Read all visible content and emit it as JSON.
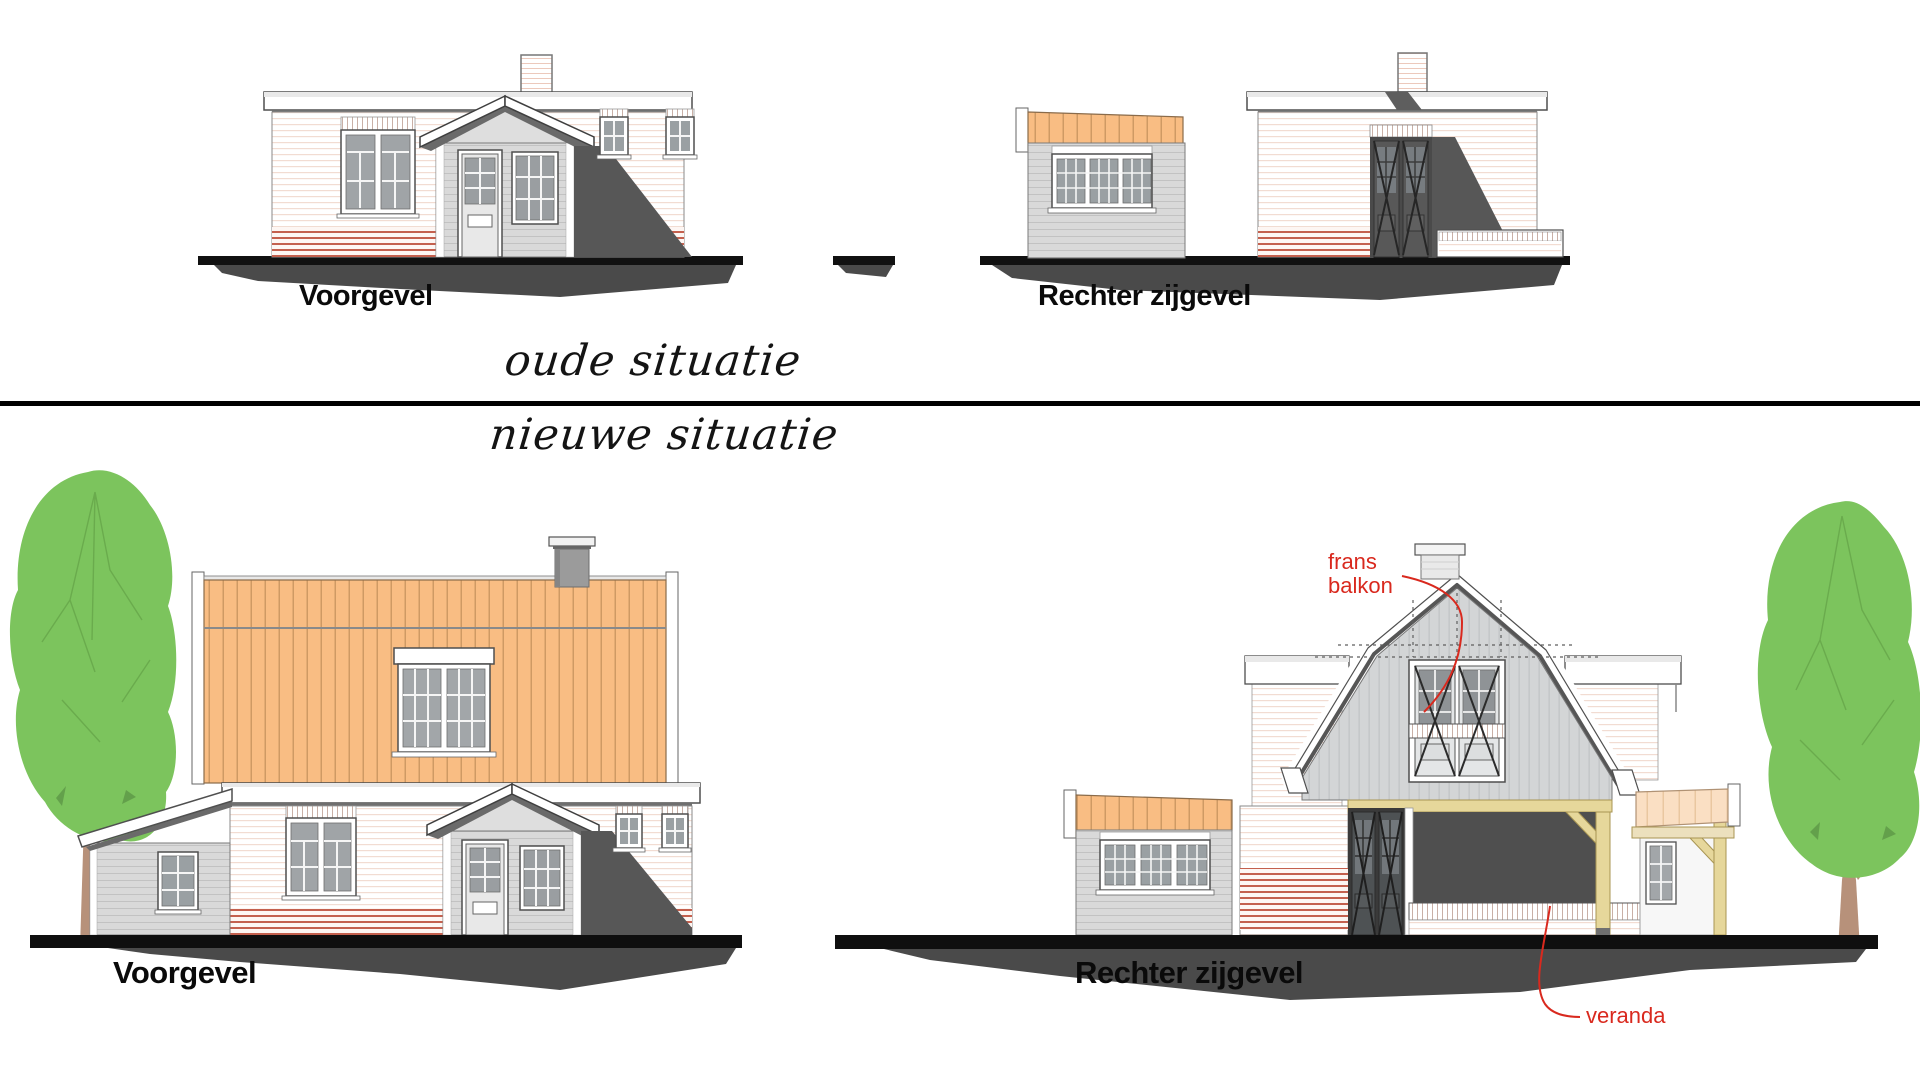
{
  "page": {
    "background": "#ffffff",
    "divider_color": "#000000"
  },
  "sections": {
    "old": {
      "title": "oude situatie",
      "drawings": [
        {
          "label": "Voorgevel"
        },
        {
          "label": "Rechter zijgevel"
        }
      ]
    },
    "new": {
      "title": "nieuwe situatie",
      "drawings": [
        {
          "label": "Voorgevel"
        },
        {
          "label": "Rechter zijgevel"
        }
      ],
      "annotations": [
        {
          "label": "frans balkon",
          "color": "#d9291e"
        },
        {
          "label": "veranda",
          "color": "#d9291e"
        }
      ]
    }
  },
  "colors": {
    "roof_orange": "#f9bd83",
    "roof_stripe": "#cf9a64",
    "veranda_roof": "#fadfc3",
    "wood_yellow": "#e6d79b",
    "tree_green": "#7cc45d",
    "trunk_brown": "#b7917a",
    "annotation_red": "#d9291e",
    "shadow_gray": "#575757",
    "ground_dark": "#4a4a4a",
    "wall_gray": "#d9d9d9",
    "glazing_gray": "#a0a4a7"
  }
}
